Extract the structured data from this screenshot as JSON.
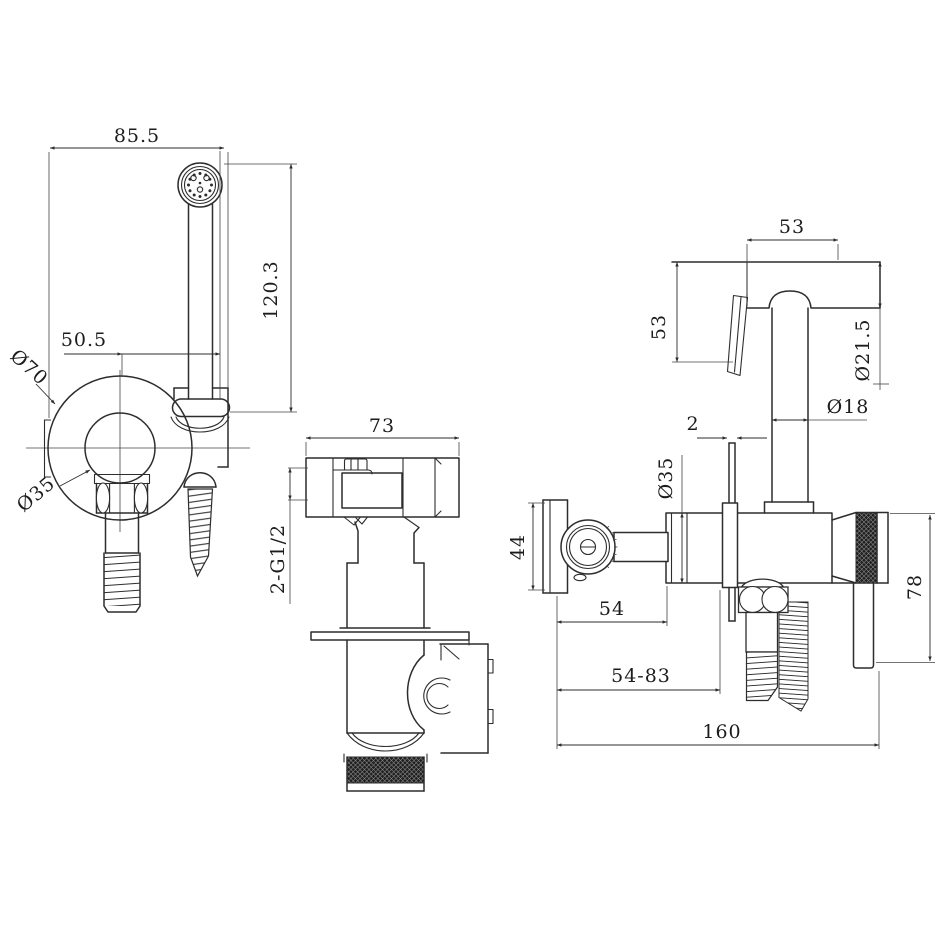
{
  "colors": {
    "line": "#2d2d2d",
    "background": "#ffffff"
  },
  "front_view": {
    "dims": {
      "width": "85.5",
      "height": "120.3",
      "center_offset": "50.5",
      "body_diameter": "Ø70",
      "knob_diameter": "Ø35"
    }
  },
  "side_view": {
    "dims": {
      "body_width": "73",
      "thread_spec": "2-G1/2"
    }
  },
  "profile_view": {
    "dims": {
      "head_depth": "53",
      "hook_drop": "53",
      "head_diameter": "Ø21.5",
      "handle_diameter": "Ø18",
      "plate_thickness": "2",
      "valve_diameter": "Ø35",
      "handle_plate_height": "44",
      "wall_to_body": "54",
      "adjust_range": "54-83",
      "overall_depth": "160",
      "grip_length": "78"
    }
  }
}
